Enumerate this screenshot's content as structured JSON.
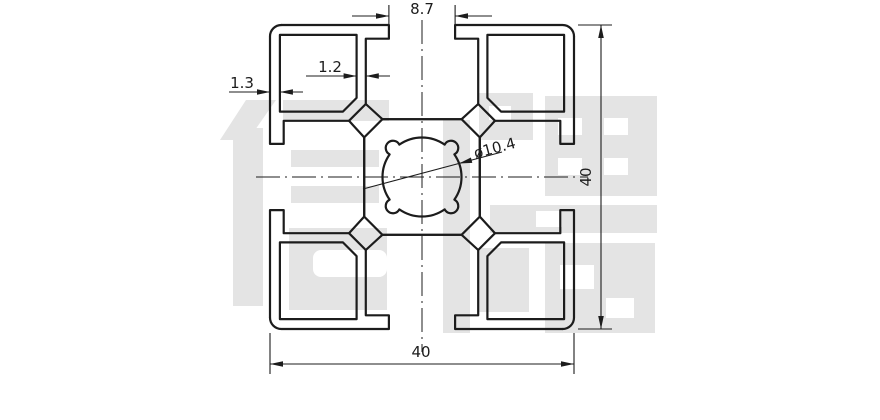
{
  "watermark": {
    "text": "信牌"
  },
  "dimensions": {
    "slot_opening": "8.7",
    "outer_wall_thickness": "1.3",
    "inner_wall_thickness": "1.2",
    "center_hole_diameter": "ø10.4",
    "overall_height": "40",
    "overall_width": "40"
  },
  "colors": {
    "line": "#1c1c1c",
    "watermark": "#e4e4e4",
    "background": "#ffffff"
  }
}
